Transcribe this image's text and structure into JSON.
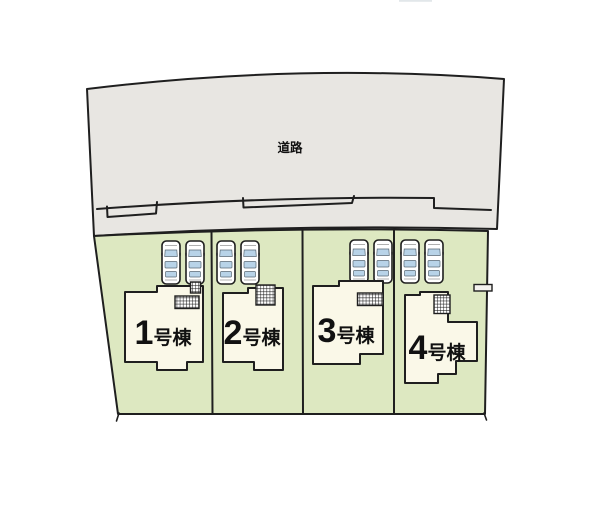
{
  "road": {
    "label": "道路"
  },
  "lots": [
    {
      "number": "1",
      "suffix": "号棟",
      "cars": 2
    },
    {
      "number": "2",
      "suffix": "号棟",
      "cars": 2
    },
    {
      "number": "3",
      "suffix": "号棟",
      "cars": 2
    },
    {
      "number": "4",
      "suffix": "号棟",
      "cars": 2
    }
  ],
  "colors": {
    "background": "#ffffff",
    "road_fill": "#e8e6e2",
    "lot_fill": "#dde8c1",
    "house_fill": "#faf8e8",
    "outline": "#1f1f1f",
    "car_body": "#ffffff",
    "car_window": "#b8d3e8",
    "text": "#111111"
  }
}
